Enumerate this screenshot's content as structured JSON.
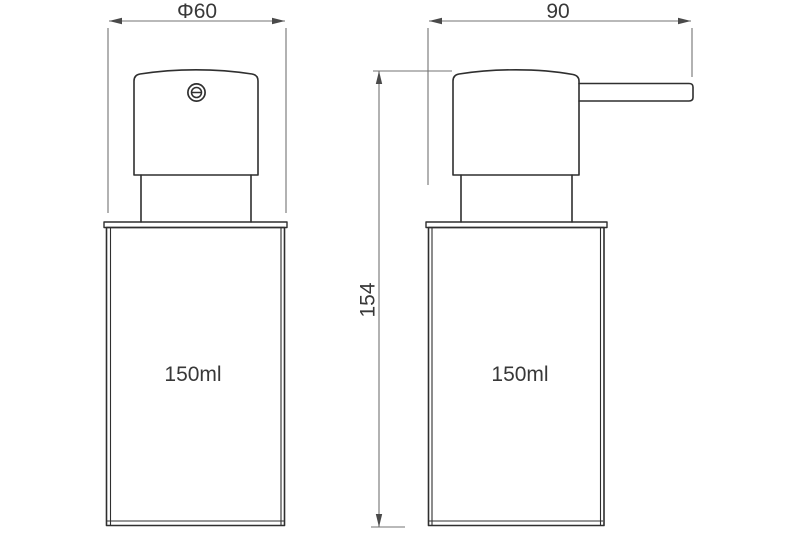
{
  "drawing": {
    "kind": "technical-drawing",
    "subject": "soap dispenser pump bottle, two orthographic views",
    "views": {
      "front": {
        "diameter_dim": "Φ60",
        "volume": "150ml"
      },
      "side": {
        "depth_dim": "90",
        "height_dim": "154",
        "volume": "150ml"
      }
    },
    "colors": {
      "background": "#ffffff",
      "outline": "#2f2f2f",
      "dimension_line": "#737373",
      "text": "#383838"
    }
  }
}
